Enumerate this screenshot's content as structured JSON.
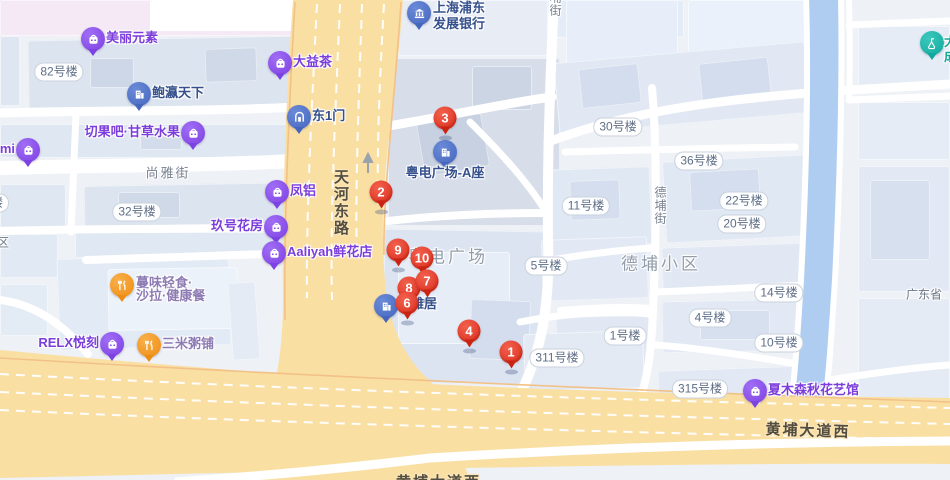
{
  "colors": {
    "marker_red": "#da2c1b",
    "poi_purple": "#7d42e4",
    "poi_blue": "#4466bd",
    "poi_orange": "#ee8c12",
    "poi_teal": "#0fa89c",
    "road_yellow": "#fadfa3",
    "river_blue": "#aecdf0",
    "building_fill": "#dfe7f2"
  },
  "road_labels": [
    {
      "text": "天河东路",
      "x": 330,
      "y": 169,
      "vertical": true
    },
    {
      "text": "黄埔大道西",
      "x": 808,
      "y": 430,
      "centered": true
    },
    {
      "text": "黄埔大道西",
      "x": 396,
      "y": 471,
      "partial": true
    }
  ],
  "street_labels": [
    {
      "text": "尚雅街",
      "x": 168,
      "y": 172,
      "centered": true
    },
    {
      "text": "德埔街",
      "x": 652,
      "y": 186,
      "vertical": true
    },
    {
      "text": "埔街",
      "x": 547,
      "y": -9,
      "vertical": true
    }
  ],
  "area_labels": [
    {
      "text": "粤电广场",
      "x": 448,
      "y": 255
    },
    {
      "text": "德埔小区",
      "x": 661,
      "y": 262
    }
  ],
  "building_labels": [
    {
      "text": "82号楼",
      "x": 59,
      "y": 72
    },
    {
      "text": "32号楼",
      "x": 137,
      "y": 212
    },
    {
      "text": "30号楼",
      "x": 618,
      "y": 127
    },
    {
      "text": "36号楼",
      "x": 699,
      "y": 161
    },
    {
      "text": "11号楼",
      "x": 586,
      "y": 206
    },
    {
      "text": "22号楼",
      "x": 744,
      "y": 201
    },
    {
      "text": "20号楼",
      "x": 742,
      "y": 224
    },
    {
      "text": "5号楼",
      "x": 546,
      "y": 266
    },
    {
      "text": "14号楼",
      "x": 779,
      "y": 293
    },
    {
      "text": "4号楼",
      "x": 710,
      "y": 318
    },
    {
      "text": "1号楼",
      "x": 625,
      "y": 336
    },
    {
      "text": "10号楼",
      "x": 779,
      "y": 343
    },
    {
      "text": "311号楼",
      "x": 557,
      "y": 358
    },
    {
      "text": "315号楼",
      "x": 700,
      "y": 389
    },
    {
      "text": "楼",
      "x": -3,
      "y": 203
    }
  ],
  "plain_labels": [
    {
      "text": "小区",
      "x": -15,
      "y": 242
    },
    {
      "text": "广东省",
      "x": 906,
      "y": 294
    }
  ],
  "markers": [
    {
      "n": "1",
      "x": 511,
      "y": 352
    },
    {
      "n": "2",
      "x": 381,
      "y": 192
    },
    {
      "n": "3",
      "x": 445,
      "y": 118
    },
    {
      "n": "4",
      "x": 469,
      "y": 331
    },
    {
      "n": "6",
      "x": 407,
      "y": 303,
      "z": 8
    },
    {
      "n": "7",
      "x": 427,
      "y": 281,
      "z": 7
    },
    {
      "n": "8",
      "x": 409,
      "y": 288,
      "z": 6
    },
    {
      "n": "9",
      "x": 398,
      "y": 250
    },
    {
      "n": "10",
      "x": 422,
      "y": 258
    }
  ],
  "pois": [
    {
      "name": "美丽元素",
      "icon": "bag-icon",
      "cat": "purple",
      "pin": [
        93,
        39
      ],
      "side": "right"
    },
    {
      "name": "大益茶",
      "icon": "bag-icon",
      "cat": "purple",
      "pin": [
        280,
        63
      ],
      "side": "right"
    },
    {
      "name": "鲍瀛天下",
      "icon": "building-icon",
      "cat": "blue",
      "pin": [
        139,
        94
      ],
      "side": "right"
    },
    {
      "name": "切果吧·甘草水果",
      "icon": "bag-icon",
      "cat": "purple",
      "pin": [
        193,
        133
      ],
      "side": "left"
    },
    {
      "name": "东1门",
      "icon": "gate-icon",
      "cat": "blue",
      "pin": [
        299,
        117
      ],
      "side": "right"
    },
    {
      "name": "凤铝",
      "icon": "bag-icon",
      "cat": "purple",
      "pin": [
        277,
        192
      ],
      "side": "right"
    },
    {
      "name": "玖号花房",
      "icon": "bag-icon",
      "cat": "purple",
      "pin": [
        276,
        227
      ],
      "side": "left"
    },
    {
      "name": "Aaliyah鲜花店",
      "icon": "bag-icon",
      "cat": "purple",
      "pin": [
        274,
        253
      ],
      "side": "right"
    },
    {
      "name": "mi",
      "icon": "bag-icon",
      "cat": "purple",
      "pin": [
        28,
        150
      ],
      "side": "left"
    },
    {
      "name": "蔓味轻食·沙拉·健康餐",
      "lines": [
        "蔓味轻食·",
        "沙拉·健康餐"
      ],
      "icon": "food-icon",
      "cat": "orange",
      "pin": [
        122,
        285
      ],
      "label": [
        136,
        276
      ],
      "lh": 13
    },
    {
      "name": "RELX悦刻",
      "icon": "bag-icon",
      "cat": "purple",
      "pin": [
        112,
        344
      ],
      "side": "left"
    },
    {
      "name": "三米粥铺",
      "icon": "food-icon",
      "cat": "orange",
      "pin": [
        149,
        345
      ],
      "side": "right"
    },
    {
      "name": "上海浦东发展银行",
      "lines": [
        "上海浦东",
        "发展银行"
      ],
      "icon": "bank-icon",
      "cat": "blue",
      "pin": [
        419,
        13
      ],
      "label": [
        433,
        0
      ],
      "lh": 16
    },
    {
      "name": "粤电广场-A座",
      "icon": "building-icon",
      "cat": "blue",
      "pin": [
        445,
        152
      ],
      "label": [
        445,
        166
      ],
      "anchor": "center"
    },
    {
      "name": "岭雅居",
      "icon": "building-icon",
      "cat": "blue",
      "pin": [
        386,
        306
      ],
      "label": [
        398,
        297
      ],
      "z": 3
    },
    {
      "name": "夏木森秋花艺馆",
      "icon": "bag-icon",
      "cat": "purple",
      "pin": [
        755,
        391
      ],
      "side": "right"
    },
    {
      "name": "大成",
      "lines": [
        "大",
        "成"
      ],
      "icon": "flask-icon",
      "cat": "teal",
      "pin": [
        932,
        43
      ],
      "label": [
        944,
        34
      ],
      "lh": 15
    }
  ]
}
